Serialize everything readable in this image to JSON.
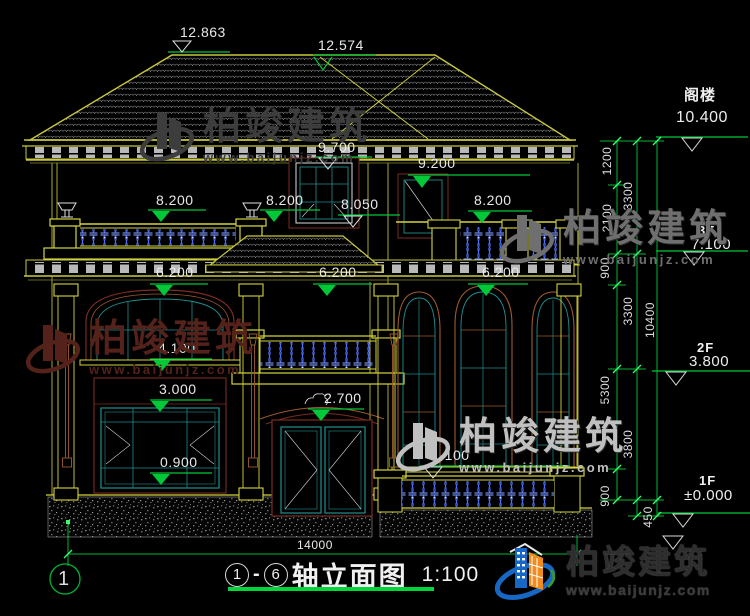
{
  "brand": {
    "name": "柏竣建筑",
    "url": "www.baijunjz.com"
  },
  "title": {
    "axis_start": "1",
    "separator": "-",
    "axis_end": "6",
    "name": "轴立面图",
    "scale": "1:100"
  },
  "axis": {
    "bubble": "1",
    "width": "14000"
  },
  "levels": [
    {
      "name": "阁楼",
      "elev": "10.400"
    },
    {
      "name": "3F",
      "elev": "7.100"
    },
    {
      "name": "2F",
      "elev": "3.800"
    },
    {
      "name": "1F",
      "elev": "±0.000"
    }
  ],
  "elevations": {
    "roof_left": "12.863",
    "roof_right": "12.574",
    "dormer_top": "9.700",
    "attic_window": "9.200",
    "balcony_left_1": "8.200",
    "balcony_left_2": "8.200",
    "dormer_sill": "8.050",
    "balcony_right": "8.200",
    "level62_left": "6.200",
    "level62_mid": "6.200",
    "level62_right": "6.200",
    "window2f_sill": "4.100",
    "window1f_top": "3.000",
    "window1f_sill": "0.900",
    "door_height": "2.700",
    "terrace_sill": "1.100"
  },
  "dims": {
    "v1200": "1200",
    "v3300_upper": "3300",
    "v2100": "2100",
    "v900_upper": "900",
    "v3300_mid": "3300",
    "v10400": "10400",
    "v5300": "5300",
    "v3800": "3800",
    "v900_lower": "900",
    "v450": "450"
  },
  "colors": {
    "background": "#000000",
    "dim_green": "#00c838",
    "building_yellow": "#d4d43c",
    "window_teal": "#1f8f8f",
    "baluster_blue": "#4d6dff",
    "surround_brown": "#9c5a30",
    "accent_maroon": "#7a2c20"
  }
}
